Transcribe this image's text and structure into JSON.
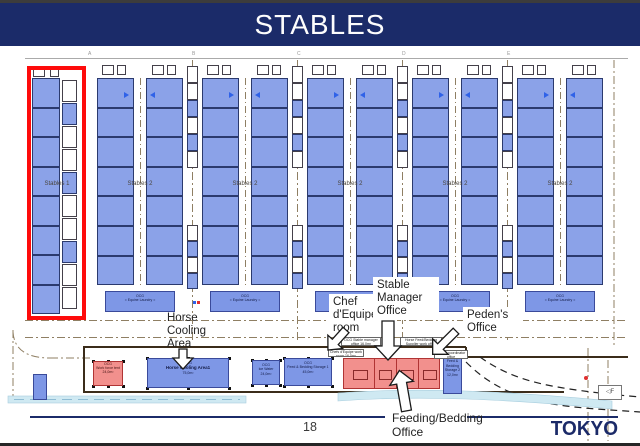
{
  "header": {
    "title": "STABLES"
  },
  "footer": {
    "page_number": "18",
    "brand": "TOKYO 2020"
  },
  "plan": {
    "grid_letters": [
      "A",
      "B",
      "C",
      "D",
      "E"
    ],
    "buildings": [
      {
        "label": "Stables 1",
        "highlighted": true
      },
      {
        "label": "Stables 2"
      },
      {
        "label": "Stables 2"
      },
      {
        "label": "Stables 2"
      },
      {
        "label": "Stables 2"
      },
      {
        "label": "Stables 2"
      }
    ],
    "laundry": {
      "code": "OCG",
      "label": "Equine Laundry"
    },
    "service_boxes": [
      {
        "code": "OCG",
        "label": "Work force tent",
        "area": "24,0m²",
        "color": "red"
      },
      {
        "code": "OCG",
        "label": "Horse Cooling Area1",
        "area": "75,0m²",
        "color": "blue"
      },
      {
        "code": "OCG",
        "label": "Ice Water",
        "area": "24,0m²",
        "color": "blue"
      },
      {
        "code": "OCG",
        "label": "Feed & Bedding Storage 1",
        "area": "45,0m²",
        "color": "blue"
      },
      {
        "code": "OCG",
        "label": "Feed & Bedding Storage 2",
        "area": "12,0m²",
        "color": "blue"
      }
    ],
    "office_labels": [
      {
        "text": "OCG Stable manager office 16,0m²"
      },
      {
        "text": "Horse Feed/Bedding Supplier work office"
      },
      {
        "text": "Chefs d'Equipe work room 16,0m²"
      },
      {
        "text": "Peden coordinator office"
      }
    ],
    "callouts": [
      {
        "id": "horse-cooling",
        "lines": [
          "Horse",
          "Cooling",
          "Area"
        ]
      },
      {
        "id": "chef-dequipe",
        "lines": [
          "Chef",
          "d'Equipe",
          "room"
        ]
      },
      {
        "id": "stable-manager",
        "lines": [
          "Stable",
          "Manager",
          "Office"
        ]
      },
      {
        "id": "pedens-office",
        "lines": [
          "Peden's",
          "Office"
        ]
      },
      {
        "id": "feeding-bedding",
        "lines": [
          "Feeding/Bedding",
          "Office"
        ]
      }
    ],
    "sign": "F"
  },
  "colors": {
    "banner_navy": "#1b2b69",
    "stall_blue": "#8ba2e8",
    "service_blue": "#7e97e6",
    "office_red": "#f2908d",
    "highlight_red": "#fe0b0b",
    "road_brown": "#8f7f63",
    "water_blue": "#cfe9f2"
  }
}
